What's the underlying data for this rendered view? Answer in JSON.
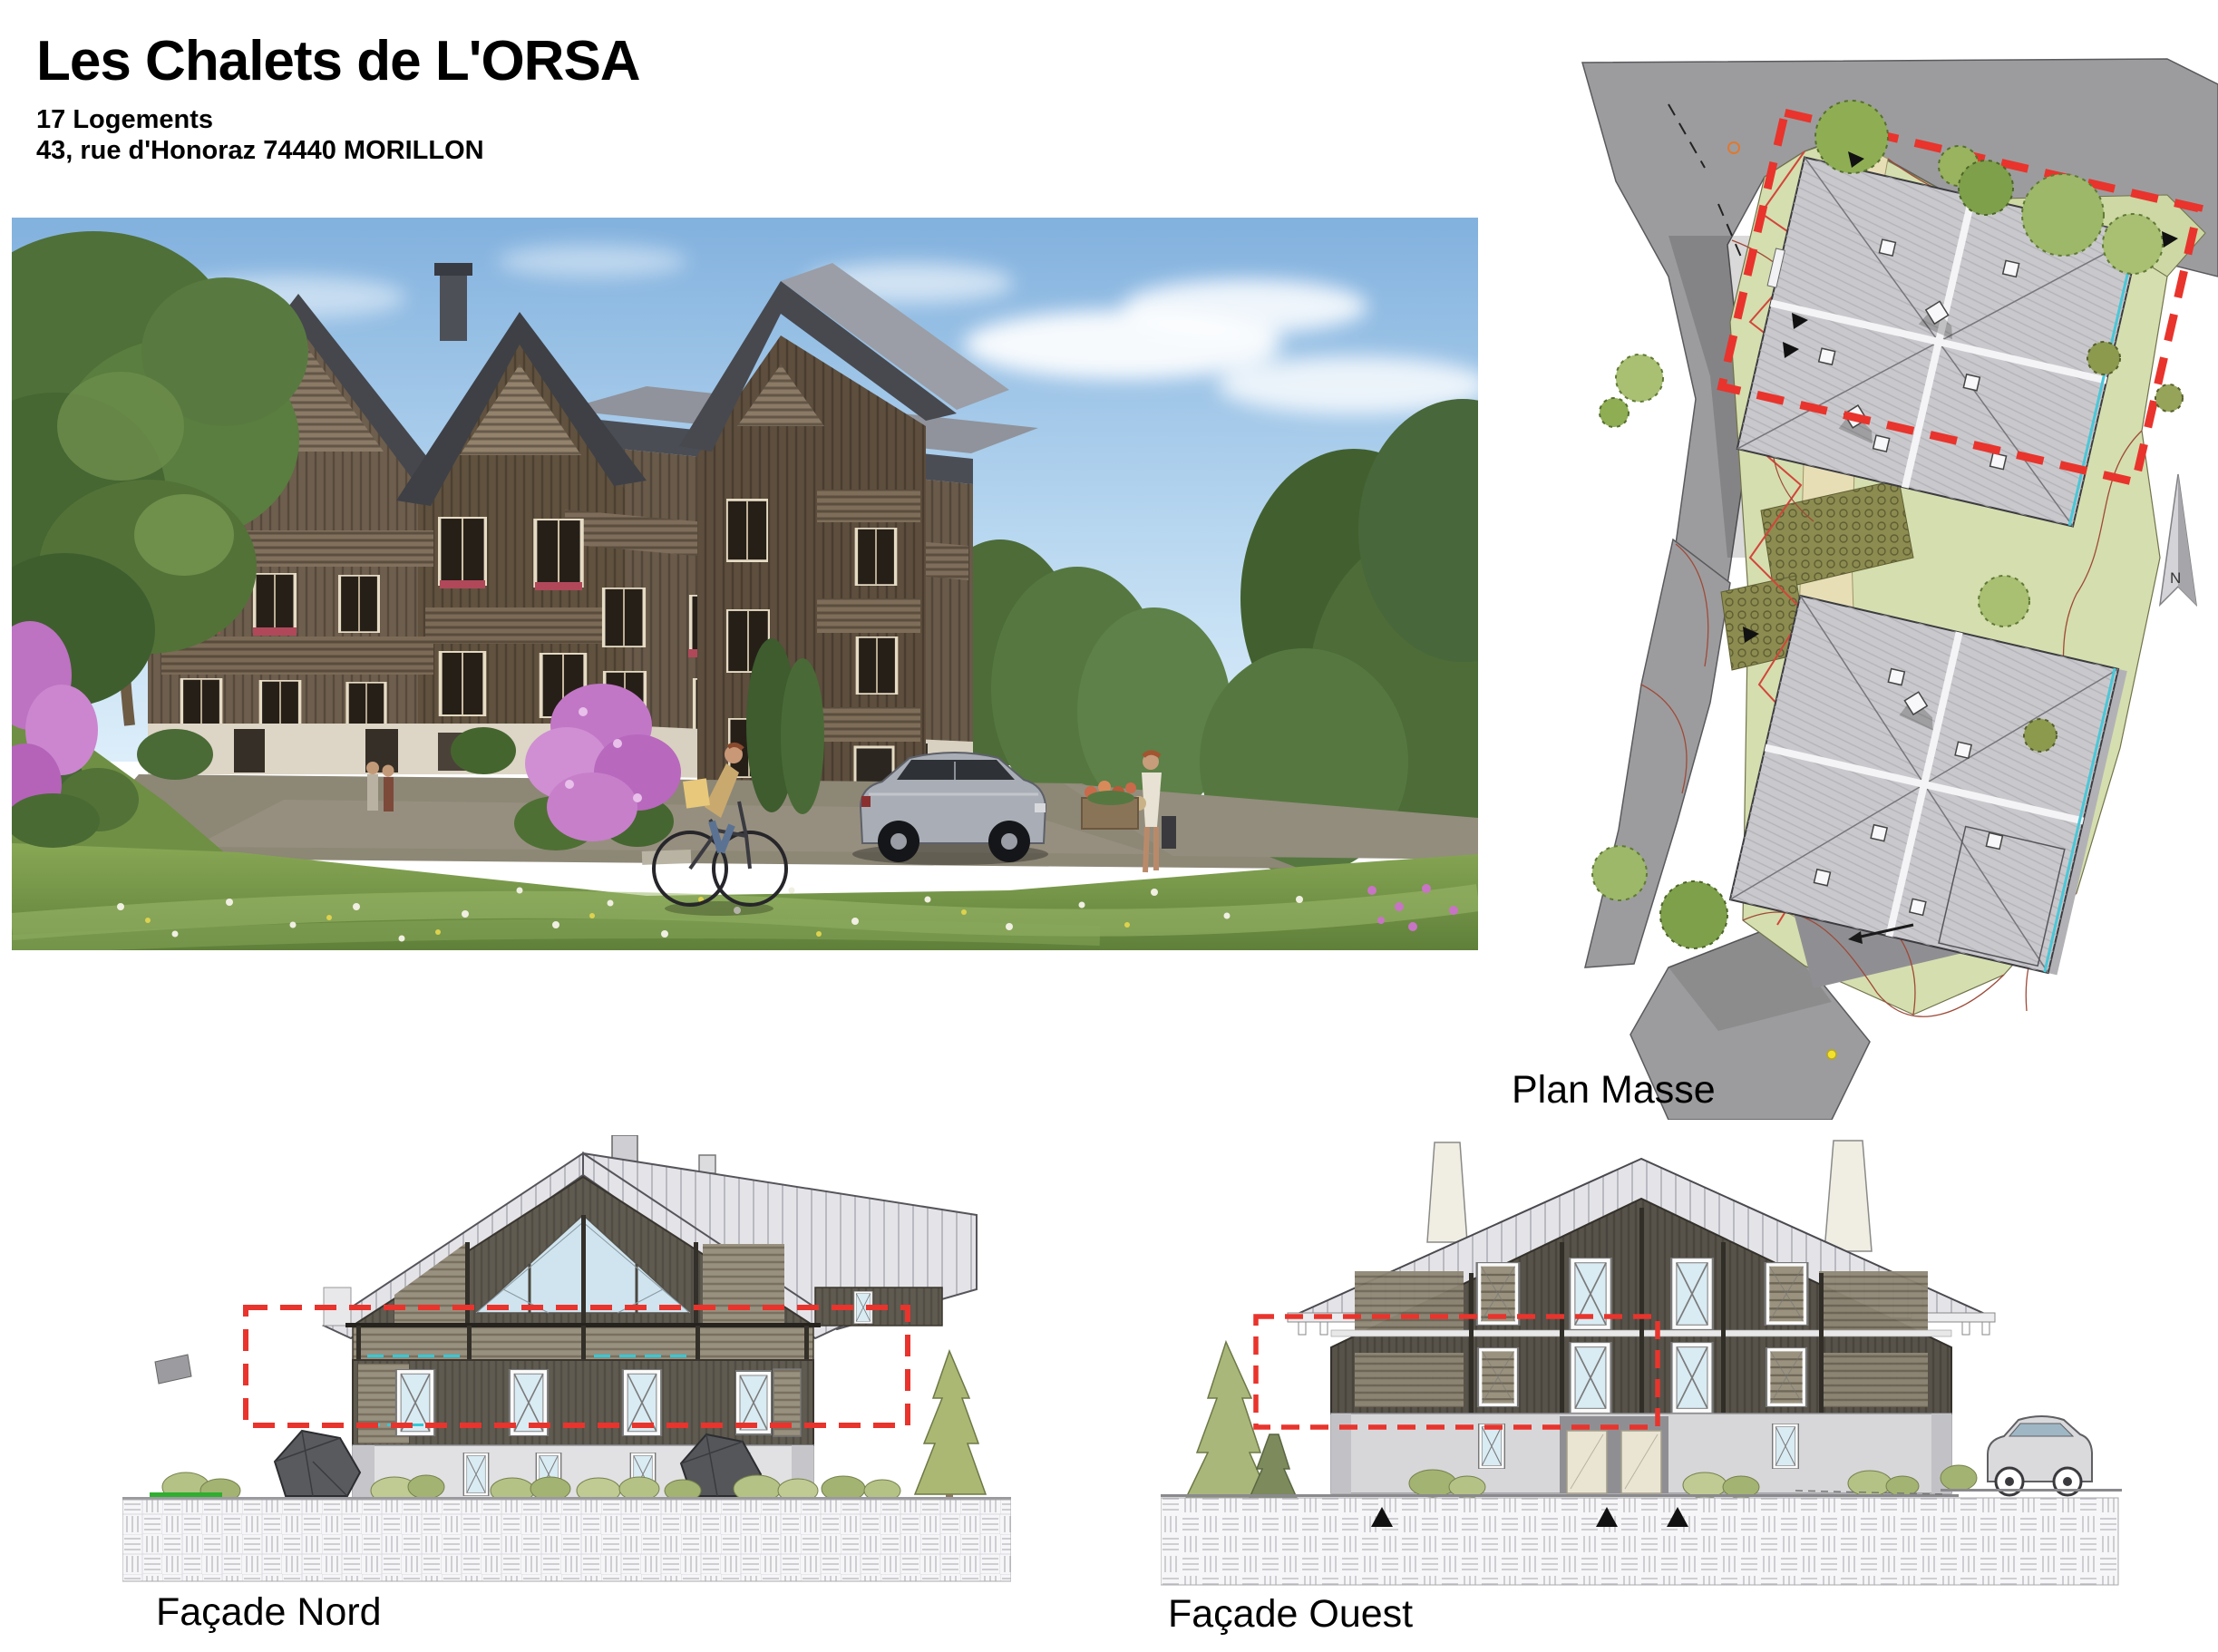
{
  "header": {
    "title": "Les Chalets de L'ORSA",
    "units": "17 Logements",
    "address": "43, rue d'Honoraz 74440 MORILLON"
  },
  "labels": {
    "site_plan": "Plan Masse",
    "facade_north": "Façade Nord",
    "facade_west": "Façade Ouest",
    "north_arrow": "N"
  },
  "colors": {
    "dashed_outline_red": "#e8342c",
    "site_green": "#d5deae",
    "road_gray": "#9c9c9e",
    "plan_roof_gray": "#c9c9cd",
    "drawing_roof_light": "#e4e4e8",
    "facade_wood_dark": "#5f5b51",
    "accent_cyan": "#3cc8d6",
    "sky_blue": "#8ab8e4",
    "grass_green": "#7c9a4e",
    "lilac_pink": "#c177c6"
  }
}
